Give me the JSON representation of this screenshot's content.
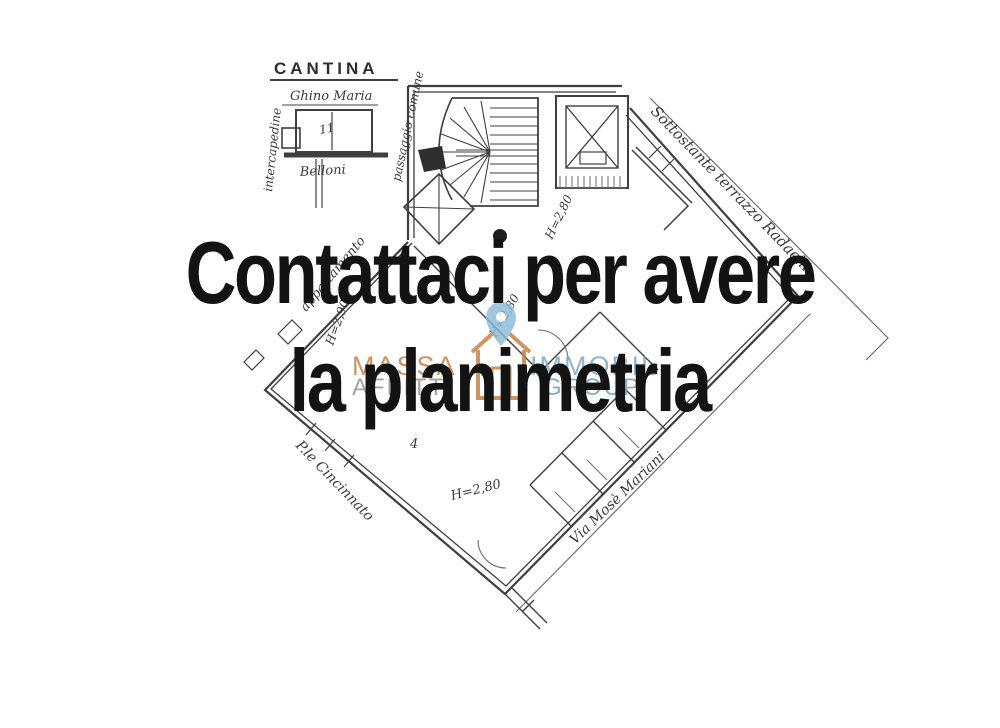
{
  "headline": {
    "line1": "Contattaci per avere",
    "line2": "la planimetria",
    "color": "#131313"
  },
  "watermark": {
    "left_top": "MASSA",
    "left_bottom": "AFFITTI",
    "right_top": "IMMOBIL",
    "right_bottom": "GROUP",
    "orange": "#c07c3e",
    "gray": "#8f8f8f",
    "blue": "#7ba6c4",
    "pin_blue": "#8cbbd9"
  },
  "plan": {
    "ink": "#3f3f3f",
    "cantina": {
      "title": "CANTINA",
      "owner": "Ghino Maria",
      "left_note": "intercapedine",
      "right_note": "passaggio comune",
      "bottom_note": "Belloni",
      "room_mark": "11"
    },
    "notes": {
      "terrace": "Sottostante terrazzo Radaelli",
      "left_side": "appartamento",
      "street_left": "P.le Cincinnato",
      "street_right": "Via Mosè Mariani",
      "room_number": "4"
    },
    "heights": {
      "h1": "H=2,90",
      "h2": "H=2,80",
      "h3": "H=2,80",
      "h4": "H=2,80"
    }
  }
}
